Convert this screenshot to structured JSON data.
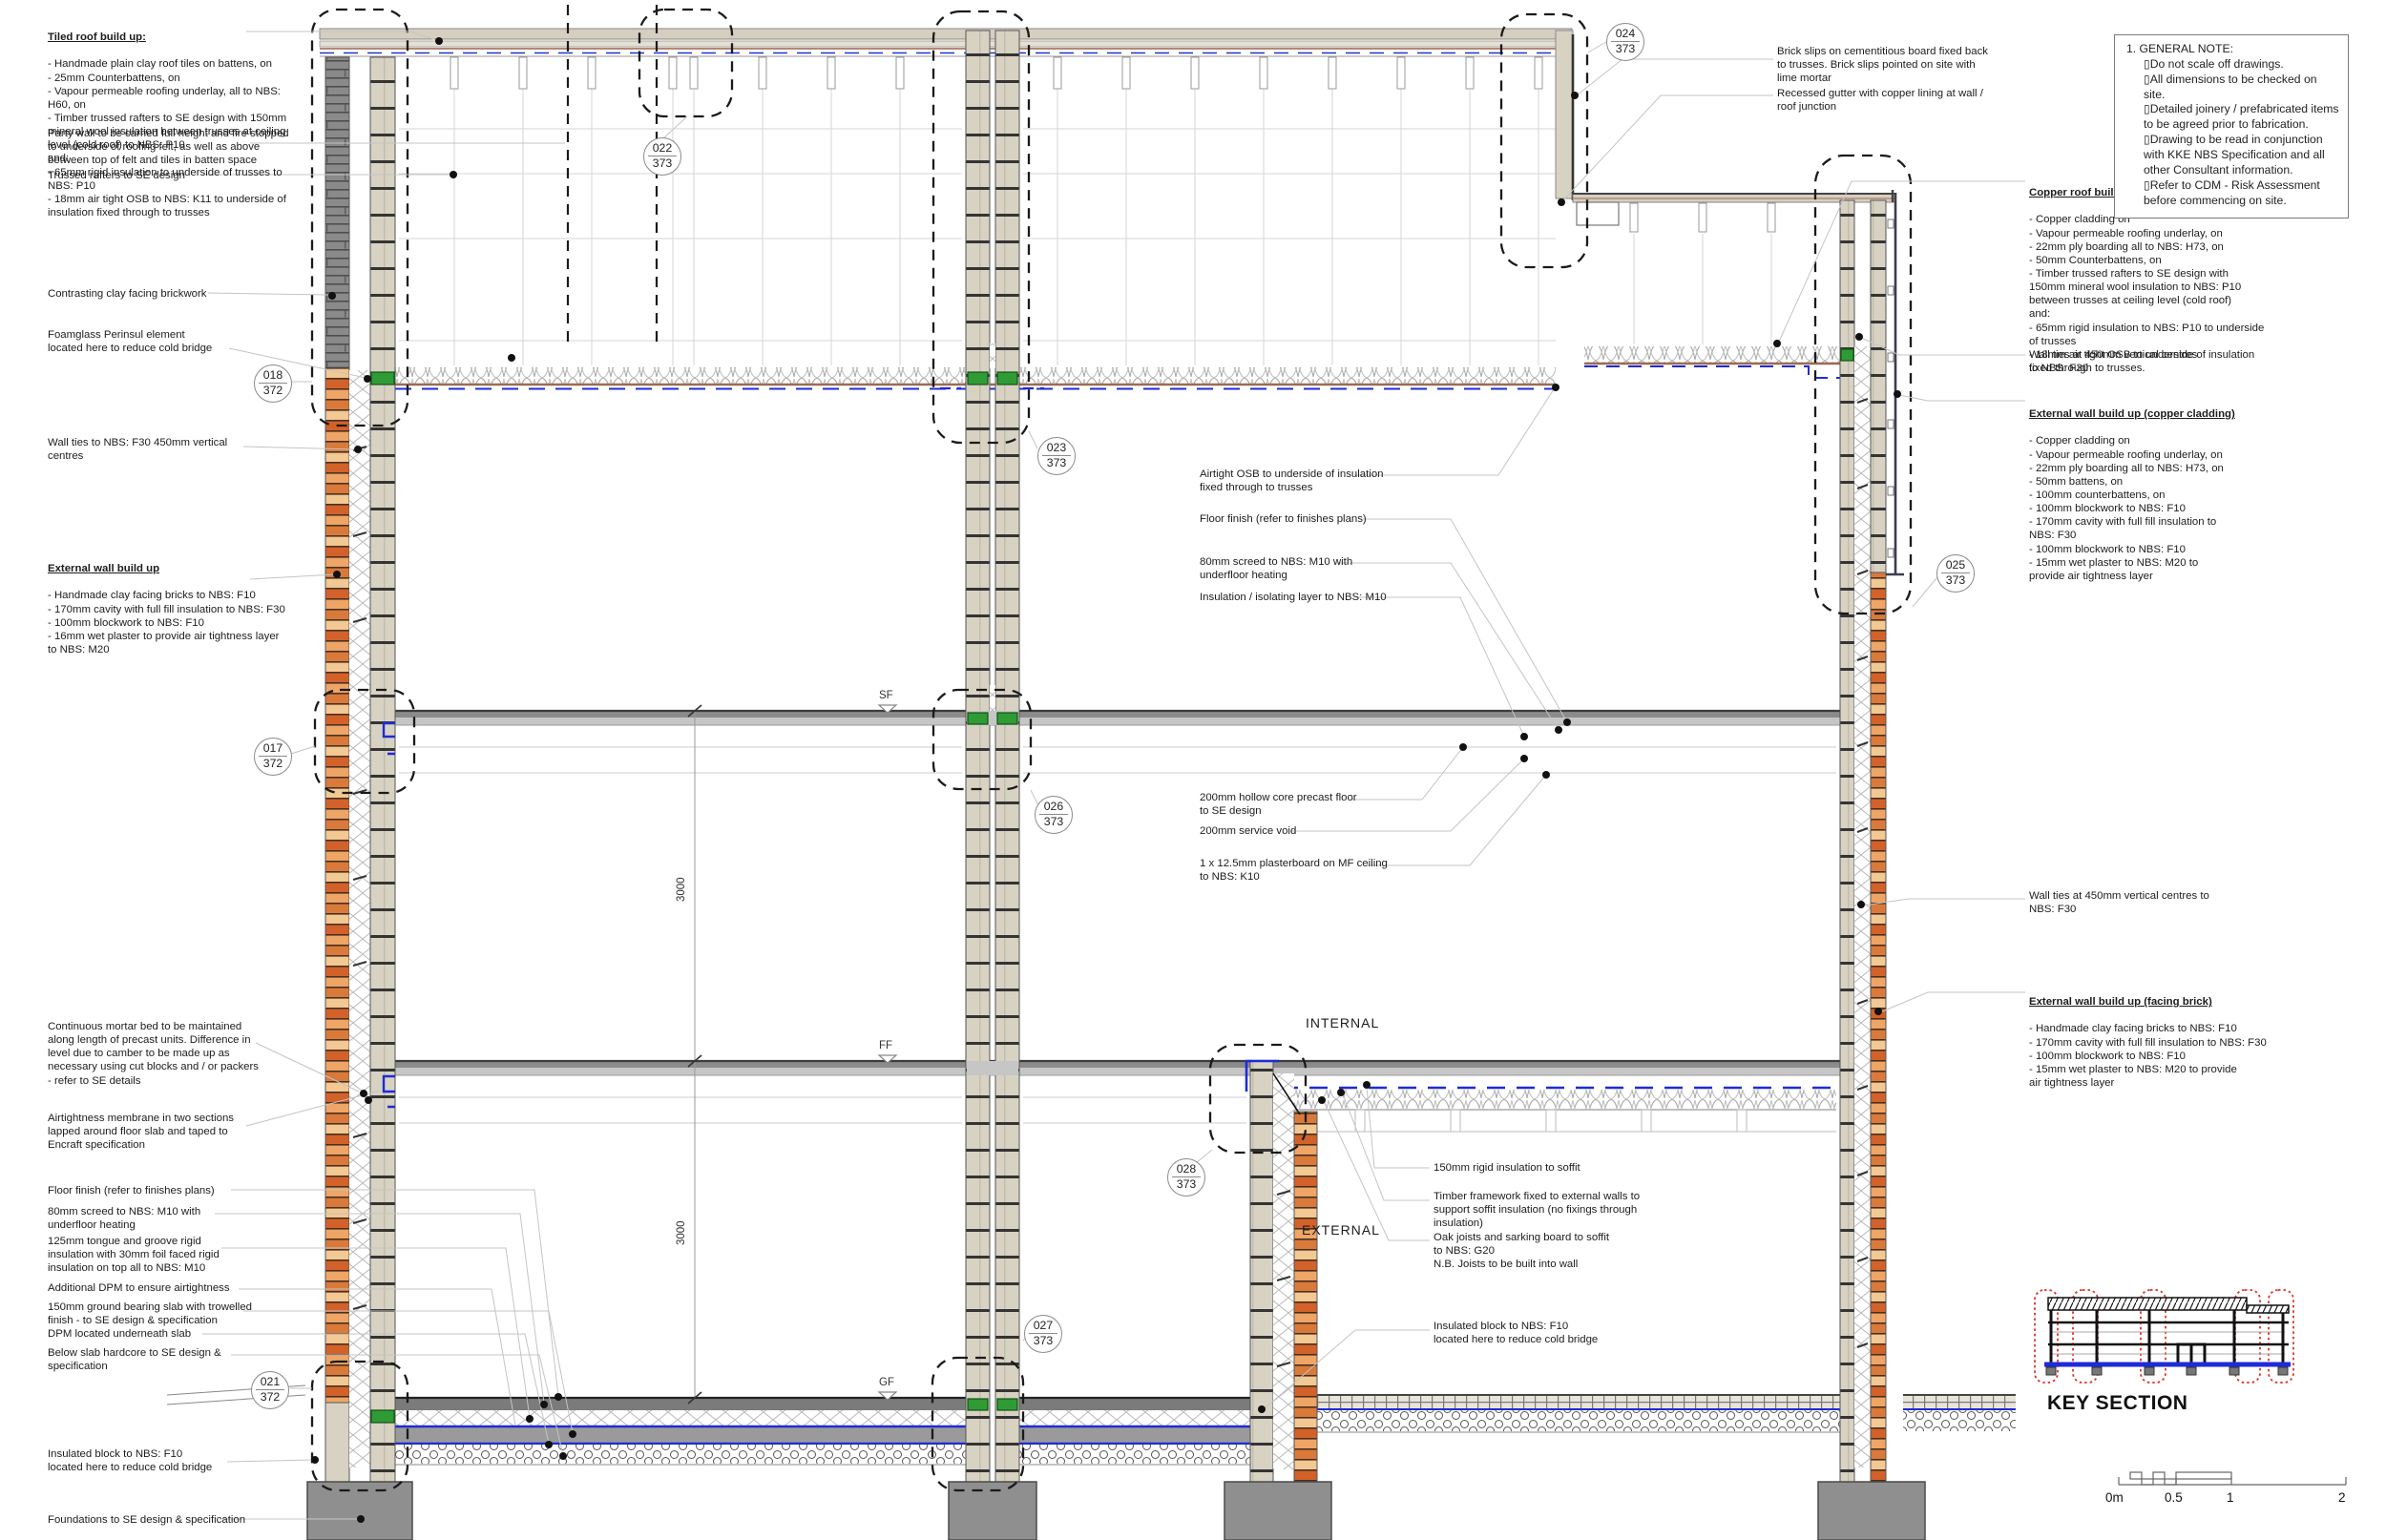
{
  "notes": {
    "tiled_roof": {
      "title": "Tiled roof build up: ",
      "body": "- Handmade plain clay roof tiles on battens, on\n- 25mm Counterbattens, on\n- Vapour permeable roofing underlay, all to NBS: H60, on\n- Timber trussed rafters to SE design with 150mm mineral wool insulation between trusses at ceiling level (cold roof) to NBS: P10\nand:\n- 65mm rigid insulation to underside of trusses to NBS: P10\n- 18mm air tight OSB to NBS: K11 to underside of insulation fixed through to trusses"
    },
    "party_wall": {
      "body": "Party wall to be carried full height and fire stopped\nto underside of roofing felt, as well as above\nbetween top of felt and tiles in batten space"
    },
    "trussed_rafters": {
      "body": "Trussed rafters to SE design"
    },
    "contrasting_brick": {
      "body": "Contrasting clay facing brickwork"
    },
    "foamglass": {
      "body": "Foamglass Perinsul element\nlocated here to reduce cold bridge"
    },
    "wall_ties_left": {
      "body": "Wall ties to NBS: F30 450mm vertical\ncentres"
    },
    "ext_wall_left": {
      "title": "External wall build up",
      "body": "- Handmade clay facing bricks to NBS: F10\n- 170mm cavity with full fill insulation to NBS: F30\n- 100mm blockwork to NBS: F10\n-  16mm wet plaster to provide air tightness layer\nto NBS: M20"
    },
    "continuous_mortar": {
      "body": "Continuous mortar bed to be maintained\nalong length of precast units. Difference in\nlevel due to camber to be made up as\nnecessary using cut blocks and / or packers\n- refer to SE details"
    },
    "airtightness_membrane": {
      "body": "Airtightness membrane in two sections\nlapped around floor slab and taped to\nEncraft specification"
    },
    "floor_finish_left": {
      "body": " Floor finish (refer to finishes plans)"
    },
    "screed_left": {
      "body": "80mm screed to NBS: M10 with\nunderfloor heating"
    },
    "insulation_125": {
      "body": "125mm tongue and groove rigid\ninsulation with 30mm foil faced rigid\ninsulation on top all to NBS: M10"
    },
    "additional_dpm": {
      "body": "Additional DPM to ensure airtightness"
    },
    "ground_slab": {
      "body": "150mm ground bearing slab with trowelled\nfinish - to SE design & specification"
    },
    "dpm_under": {
      "body": "DPM located underneath slab"
    },
    "below_hardcore": {
      "body": "Below slab hardcore to SE design &\nspecification"
    },
    "insulated_block_left": {
      "body": "Insulated block to NBS: F10\nlocated here to reduce cold bridge"
    },
    "foundations": {
      "body": "Foundations to SE design & specification"
    },
    "brick_slips": {
      "body": "Brick slips on cementitious board fixed back\nto trusses. Brick slips pointed on site with\nlime mortar"
    },
    "recessed_gutter": {
      "body": "Recessed gutter with copper lining at wall /\nroof junction"
    },
    "airtight_osb": {
      "body": "Airtight OSB to underside of insulation\nfixed through to trusses"
    },
    "floor_finish_mid": {
      "body": "Floor finish (refer to finishes plans)"
    },
    "screed_mid": {
      "body": "80mm screed to NBS: M10 with\nunderfloor heating"
    },
    "insulation_iso": {
      "body": "Insulation / isolating layer to NBS: M10"
    },
    "hollow_core": {
      "body": "200mm hollow core precast floor\nto SE design"
    },
    "service_void": {
      "body": "200mm service void"
    },
    "plasterboard": {
      "body": "1 x 12.5mm plasterboard on MF ceiling\nto NBS: K10"
    },
    "rigid_soffit": {
      "body": "150mm rigid insulation to soffit"
    },
    "timber_framework": {
      "body": "Timber framework fixed to external walls to\nsupport soffit insulation (no fixings through\ninsulation)"
    },
    "oak_joists": {
      "body": "Oak joists and sarking board to soffit\nto NBS: G20\nN.B. Joists to be built into wall"
    },
    "insulated_block_mid": {
      "body": "Insulated block to NBS: F10\nlocated here to reduce cold bridge"
    },
    "copper_roof": {
      "title": "Copper roof build up: ",
      "body": "- Copper cladding on\n- Vapour permeable roofing underlay, on\n- 22mm ply boarding all to NBS: H73, on\n- 50mm Counterbattens, on\n- Timber trussed rafters to SE design with 150mm mineral wool insulation to NBS: P10 between trusses at ceiling level (cold roof)\nand:\n- 65mm rigid insulation to NBS: P10 to underside of trusses\n- 18mm air tight OSB to underside of insulation fixed through to trusses."
    },
    "wall_ties_upper": {
      "body": "Wall ties at 450mm vertical centres\nto NBS: F30"
    },
    "ext_wall_copper": {
      "title": "External wall build up (copper cladding)",
      "body": "- Copper cladding on\n- Vapour permeable roofing underlay, on\n- 22mm ply boarding all to NBS: H73, on\n- 50mm battens, on\n- 100mm counterbattens, on\n- 100mm blockwork to NBS: F10\n- 170mm cavity with full fill insulation to\nNBS: F30\n- 100mm blockwork to NBS: F10\n-  15mm wet plaster to NBS: M20 to\nprovide air tightness layer"
    },
    "wall_ties_lower": {
      "body": "Wall ties at 450mm vertical centres to\nNBS: F30"
    },
    "ext_wall_brick": {
      "title": "External wall build up (facing brick)",
      "body": "- Handmade clay facing bricks to NBS: F10\n- 170mm cavity with full fill insulation to NBS: F30\n- 100mm blockwork to NBS: F10\n-  15mm wet plaster  to NBS: M20 to provide\nair tightness layer"
    }
  },
  "general_note": {
    "title": "1. GENERAL NOTE:",
    "items": [
      "▯Do not scale off drawings.",
      "▯All dimensions to be checked on site.",
      "▯Detailed joinery /  prefabricated items to be agreed prior to fabrication.",
      "▯Drawing to be read in conjunction with KKE NBS Specification and all other Consultant information.",
      "▯Refer to CDM - Risk Assessment before commencing on site."
    ]
  },
  "bubbles": {
    "d018": {
      "num": "018",
      "sheet": "372"
    },
    "d017": {
      "num": "017",
      "sheet": "372"
    },
    "d021": {
      "num": "021",
      "sheet": "372"
    },
    "d022": {
      "num": "022",
      "sheet": "373"
    },
    "d023": {
      "num": "023",
      "sheet": "373"
    },
    "d024": {
      "num": "024",
      "sheet": "373"
    },
    "d025": {
      "num": "025",
      "sheet": "373"
    },
    "d026": {
      "num": "026",
      "sheet": "373"
    },
    "d027": {
      "num": "027",
      "sheet": "373"
    },
    "d028": {
      "num": "028",
      "sheet": "373"
    }
  },
  "levels": {
    "sf": "SF",
    "ff": "FF",
    "gf": "GF"
  },
  "dimensions": {
    "storey_1": "3000",
    "storey_2": "3000"
  },
  "labels": {
    "internal": "INTERNAL",
    "external": "EXTERNAL",
    "key_section": "KEY SECTION"
  },
  "scale_bar": {
    "zero": "0m",
    "half": "0.5",
    "one": "1",
    "two": "2"
  },
  "colors": {
    "membrane_blue": "#1e2bd8",
    "perinsul_green": "#2f9b35",
    "underlay_brown": "#a97c6a",
    "key_red": "#e03024"
  }
}
